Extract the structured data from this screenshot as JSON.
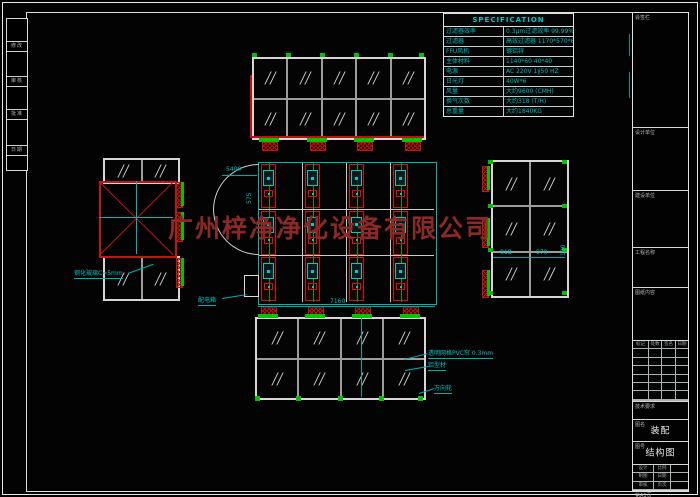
{
  "watermark": {
    "text": "广州梓净净化设备有限公司",
    "color": "#8b2a24"
  },
  "spec": {
    "title": "SPECIFICATION",
    "rows": [
      {
        "label": "过滤器效率",
        "value": "0.3μm过滤效率 99.99%"
      },
      {
        "label": "过滤器",
        "value": "高效过滤器 1170*570*69"
      },
      {
        "label": "FFU风机",
        "value": "镀铝锌"
      },
      {
        "label": "主体材料",
        "value": "1140*60  40*40"
      },
      {
        "label": "电源",
        "value": "AC 220V 1∮50 HZ"
      },
      {
        "label": "日光灯",
        "value": "40W*6"
      },
      {
        "label": "风量",
        "value": "大约9600 (CMH)"
      },
      {
        "label": "换气次数",
        "value": "大约318 (T/H)"
      },
      {
        "label": "总重量",
        "value": "大约1840KG"
      }
    ]
  },
  "dims": {
    "plan_top": "5400",
    "plan_left": "575",
    "plan_bottom": "7160",
    "right_a": "818",
    "right_b": "970",
    "right_c": "120"
  },
  "callouts": {
    "curtain": "透明网格PVC帘 0.3mm",
    "profile": "铝型材",
    "caster": "万向轮",
    "glass": "钢化玻璃C=5mm",
    "power_box": "配电箱"
  },
  "title_block": {
    "s1": "会签栏",
    "s2": "设计单位",
    "s3": "建设单位",
    "s4": "工程名称",
    "s5": "图纸内容",
    "rev_headers": [
      "标记",
      "处数",
      "签名",
      "日期"
    ],
    "s7": "技术要求",
    "name_label": "图名",
    "name_value": "装配",
    "no_label": "图号",
    "no_value": "结构图",
    "sign_rows": [
      [
        "设计",
        "比例"
      ],
      [
        "制图",
        "日期"
      ],
      [
        "审核",
        "页次"
      ]
    ],
    "footer": "第A1页"
  },
  "margin_cells": [
    "修改",
    "审核",
    "批准",
    "日期"
  ]
}
